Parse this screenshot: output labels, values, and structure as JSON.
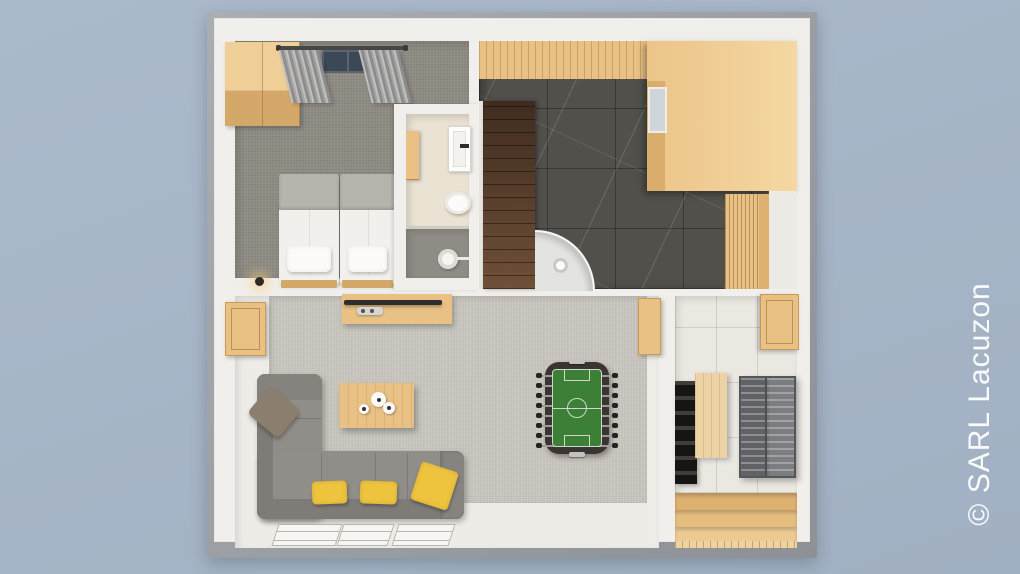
{
  "watermark": {
    "text": "© SARL Lacuzon"
  },
  "scene": {
    "type": "3d-floor-plan-top-down-render",
    "rooms": [
      {
        "id": "bedroom",
        "floor": "gray carpet",
        "furniture": [
          "wardrobe",
          "curtain rail",
          "curtains",
          "window",
          "twin bed",
          "twin bed",
          "bedside lamp"
        ]
      },
      {
        "id": "bathroom",
        "floor": "hexagonal tile and gray tile",
        "furniture": [
          "wall cabinet",
          "washbasin",
          "tap",
          "toilet",
          "shower head"
        ]
      },
      {
        "id": "spa-room",
        "floor": "dark marble tile",
        "furniture": [
          "wood plank wall band",
          "sauna cabin",
          "sauna window",
          "dark wood staircase",
          "curved shower enclosure",
          "slatted wood bench"
        ]
      },
      {
        "id": "living-room",
        "floor": "light carpet over pale tile",
        "furniture": [
          "corner sofa",
          "gray cushion",
          "yellow cushions x3",
          "coffee table",
          "vases x3",
          "sideboard",
          "tv",
          "remote",
          "wall cabinet left",
          "wall cabinet right",
          "foosball table",
          "floor mats x3"
        ]
      },
      {
        "id": "cellar",
        "floor": "cream tile",
        "furniture": [
          "wall cabinet",
          "black wine rack",
          "standing table",
          "metal storage rack",
          "light wood staircase",
          "plank floor"
        ]
      }
    ]
  },
  "colors": {
    "bg": "#abbacb",
    "bg2": "#a1b0c2",
    "watermark": "#ffffff",
    "wall": "#f1efeb",
    "carpet-bed": "#8e8b83",
    "carpet-living": "#c8c5be",
    "floor-light": "#eeece7",
    "hex-tile": "#eae2d3",
    "bath-gray": "#8f8c86",
    "marble": "#51504b",
    "wood": "#e9c185",
    "wood-dark": "#d4a868",
    "sofa": "#918e8a",
    "sofa-dark": "#7f7c78",
    "pillow-yellow": "#eec33d",
    "pillow-gray": "#8b7e6e",
    "cellar-floor": "#ebe8e2",
    "rack-black": "#2d2b29",
    "rack-metal": "#6e7073",
    "foos-frame": "#3a3531",
    "foos-field": "#3c8038"
  }
}
